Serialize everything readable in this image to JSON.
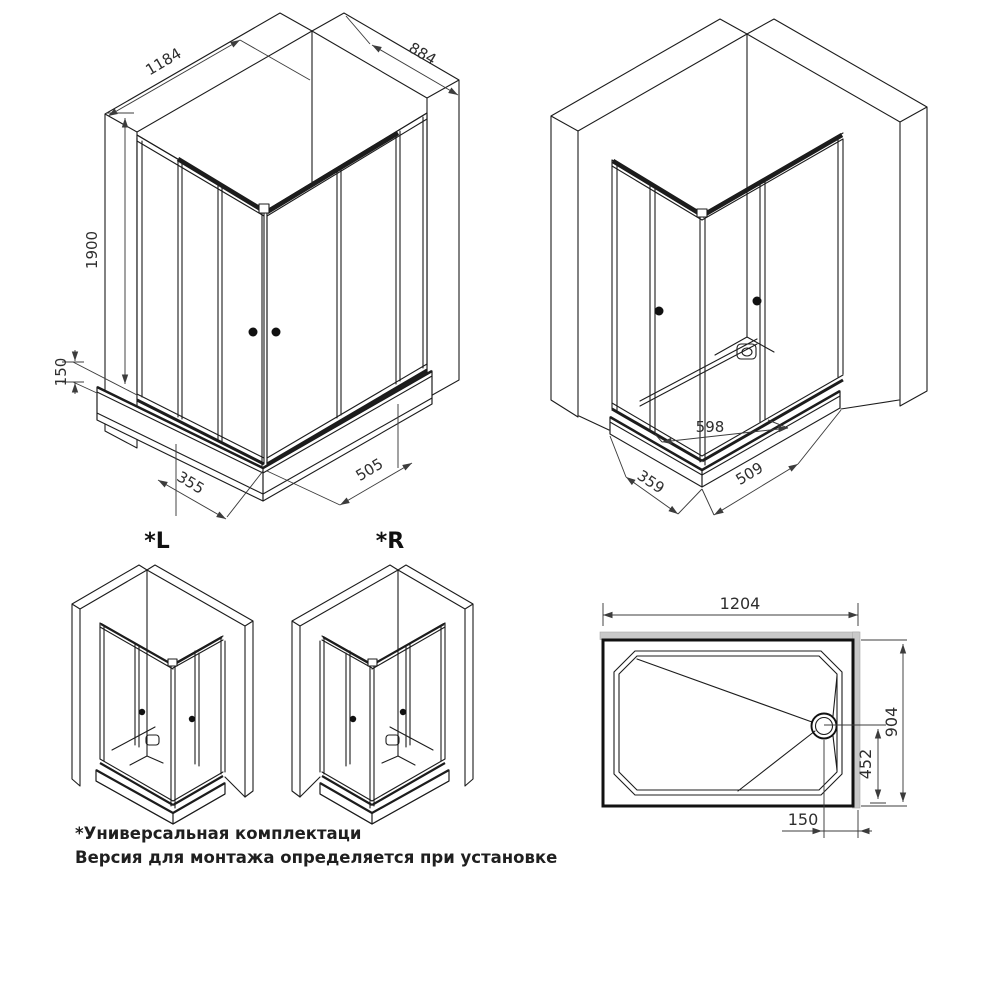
{
  "views": {
    "front_iso": {
      "width_left": "1184",
      "depth_right": "884",
      "height": "1900",
      "tray_height": "150",
      "left_door": "355",
      "right_door": "505"
    },
    "back_iso": {
      "entry_width": "598",
      "left_bottom": "359",
      "right_bottom": "509"
    },
    "variants": {
      "left": "*L",
      "right": "*R"
    },
    "tray_top": {
      "width": "1204",
      "depth": "904",
      "drain_offset_y": "452",
      "drain_offset_x": "150"
    }
  },
  "footnote": {
    "line1": "*Универсальная комплектаци",
    "line2": "Версия для монтажа определяется при установке"
  },
  "colors": {
    "line": "#1c1c1c",
    "dimension": "#3c3c3c",
    "text": "#2e2e2e",
    "wall_band": "#c9c9c9",
    "background": "#ffffff"
  }
}
